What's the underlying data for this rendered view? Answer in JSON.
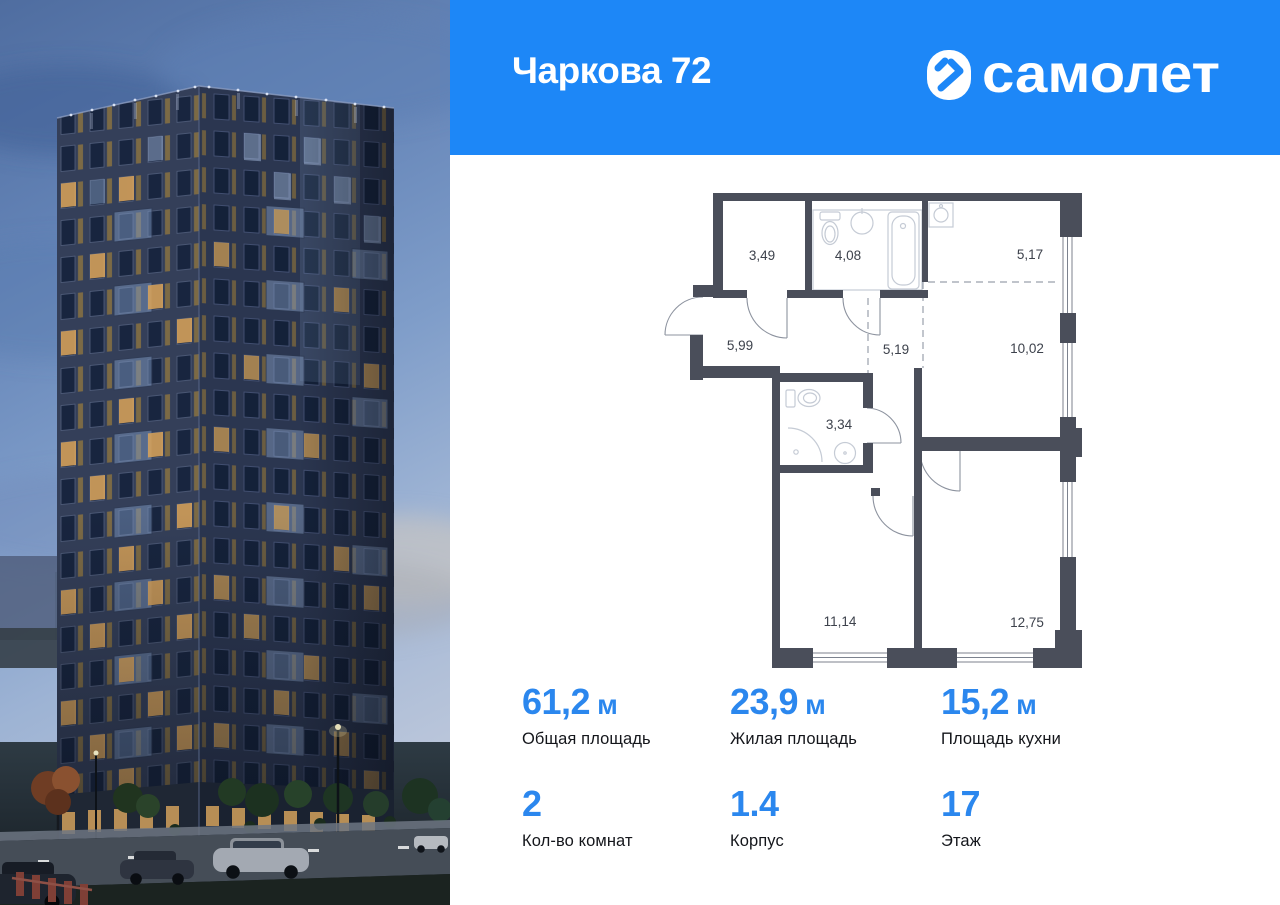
{
  "project": {
    "title": "Чаркова 72"
  },
  "brand": {
    "name": "самолет"
  },
  "floor_plan": {
    "rooms": [
      {
        "name": "hall-entry",
        "area": "3,49"
      },
      {
        "name": "bathroom-large",
        "area": "4,08"
      },
      {
        "name": "kitchen-niche",
        "area": "5,17"
      },
      {
        "name": "hallway",
        "area": "5,99"
      },
      {
        "name": "corridor",
        "area": "5,19"
      },
      {
        "name": "kitchen-living",
        "area": "10,02"
      },
      {
        "name": "bathroom-small",
        "area": "3,34"
      },
      {
        "name": "bedroom-1",
        "area": "11,14"
      },
      {
        "name": "bedroom-2",
        "area": "12,75"
      }
    ]
  },
  "stats": {
    "primary": [
      {
        "value": "61,2",
        "unit": "м",
        "label": "Общая площадь"
      },
      {
        "value": "23,9",
        "unit": "м",
        "label": "Жилая площадь"
      },
      {
        "value": "15,2",
        "unit": "м",
        "label": "Площадь кухни"
      }
    ],
    "secondary": [
      {
        "value": "2",
        "label": "Кол-во комнат"
      },
      {
        "value": "1.4",
        "label": "Корпус"
      },
      {
        "value": "17",
        "label": "Этаж"
      }
    ]
  },
  "colors": {
    "header_bg": "#1d87f7",
    "stat_value": "#2b87ee",
    "plan_wall": "#4a4e5a"
  }
}
